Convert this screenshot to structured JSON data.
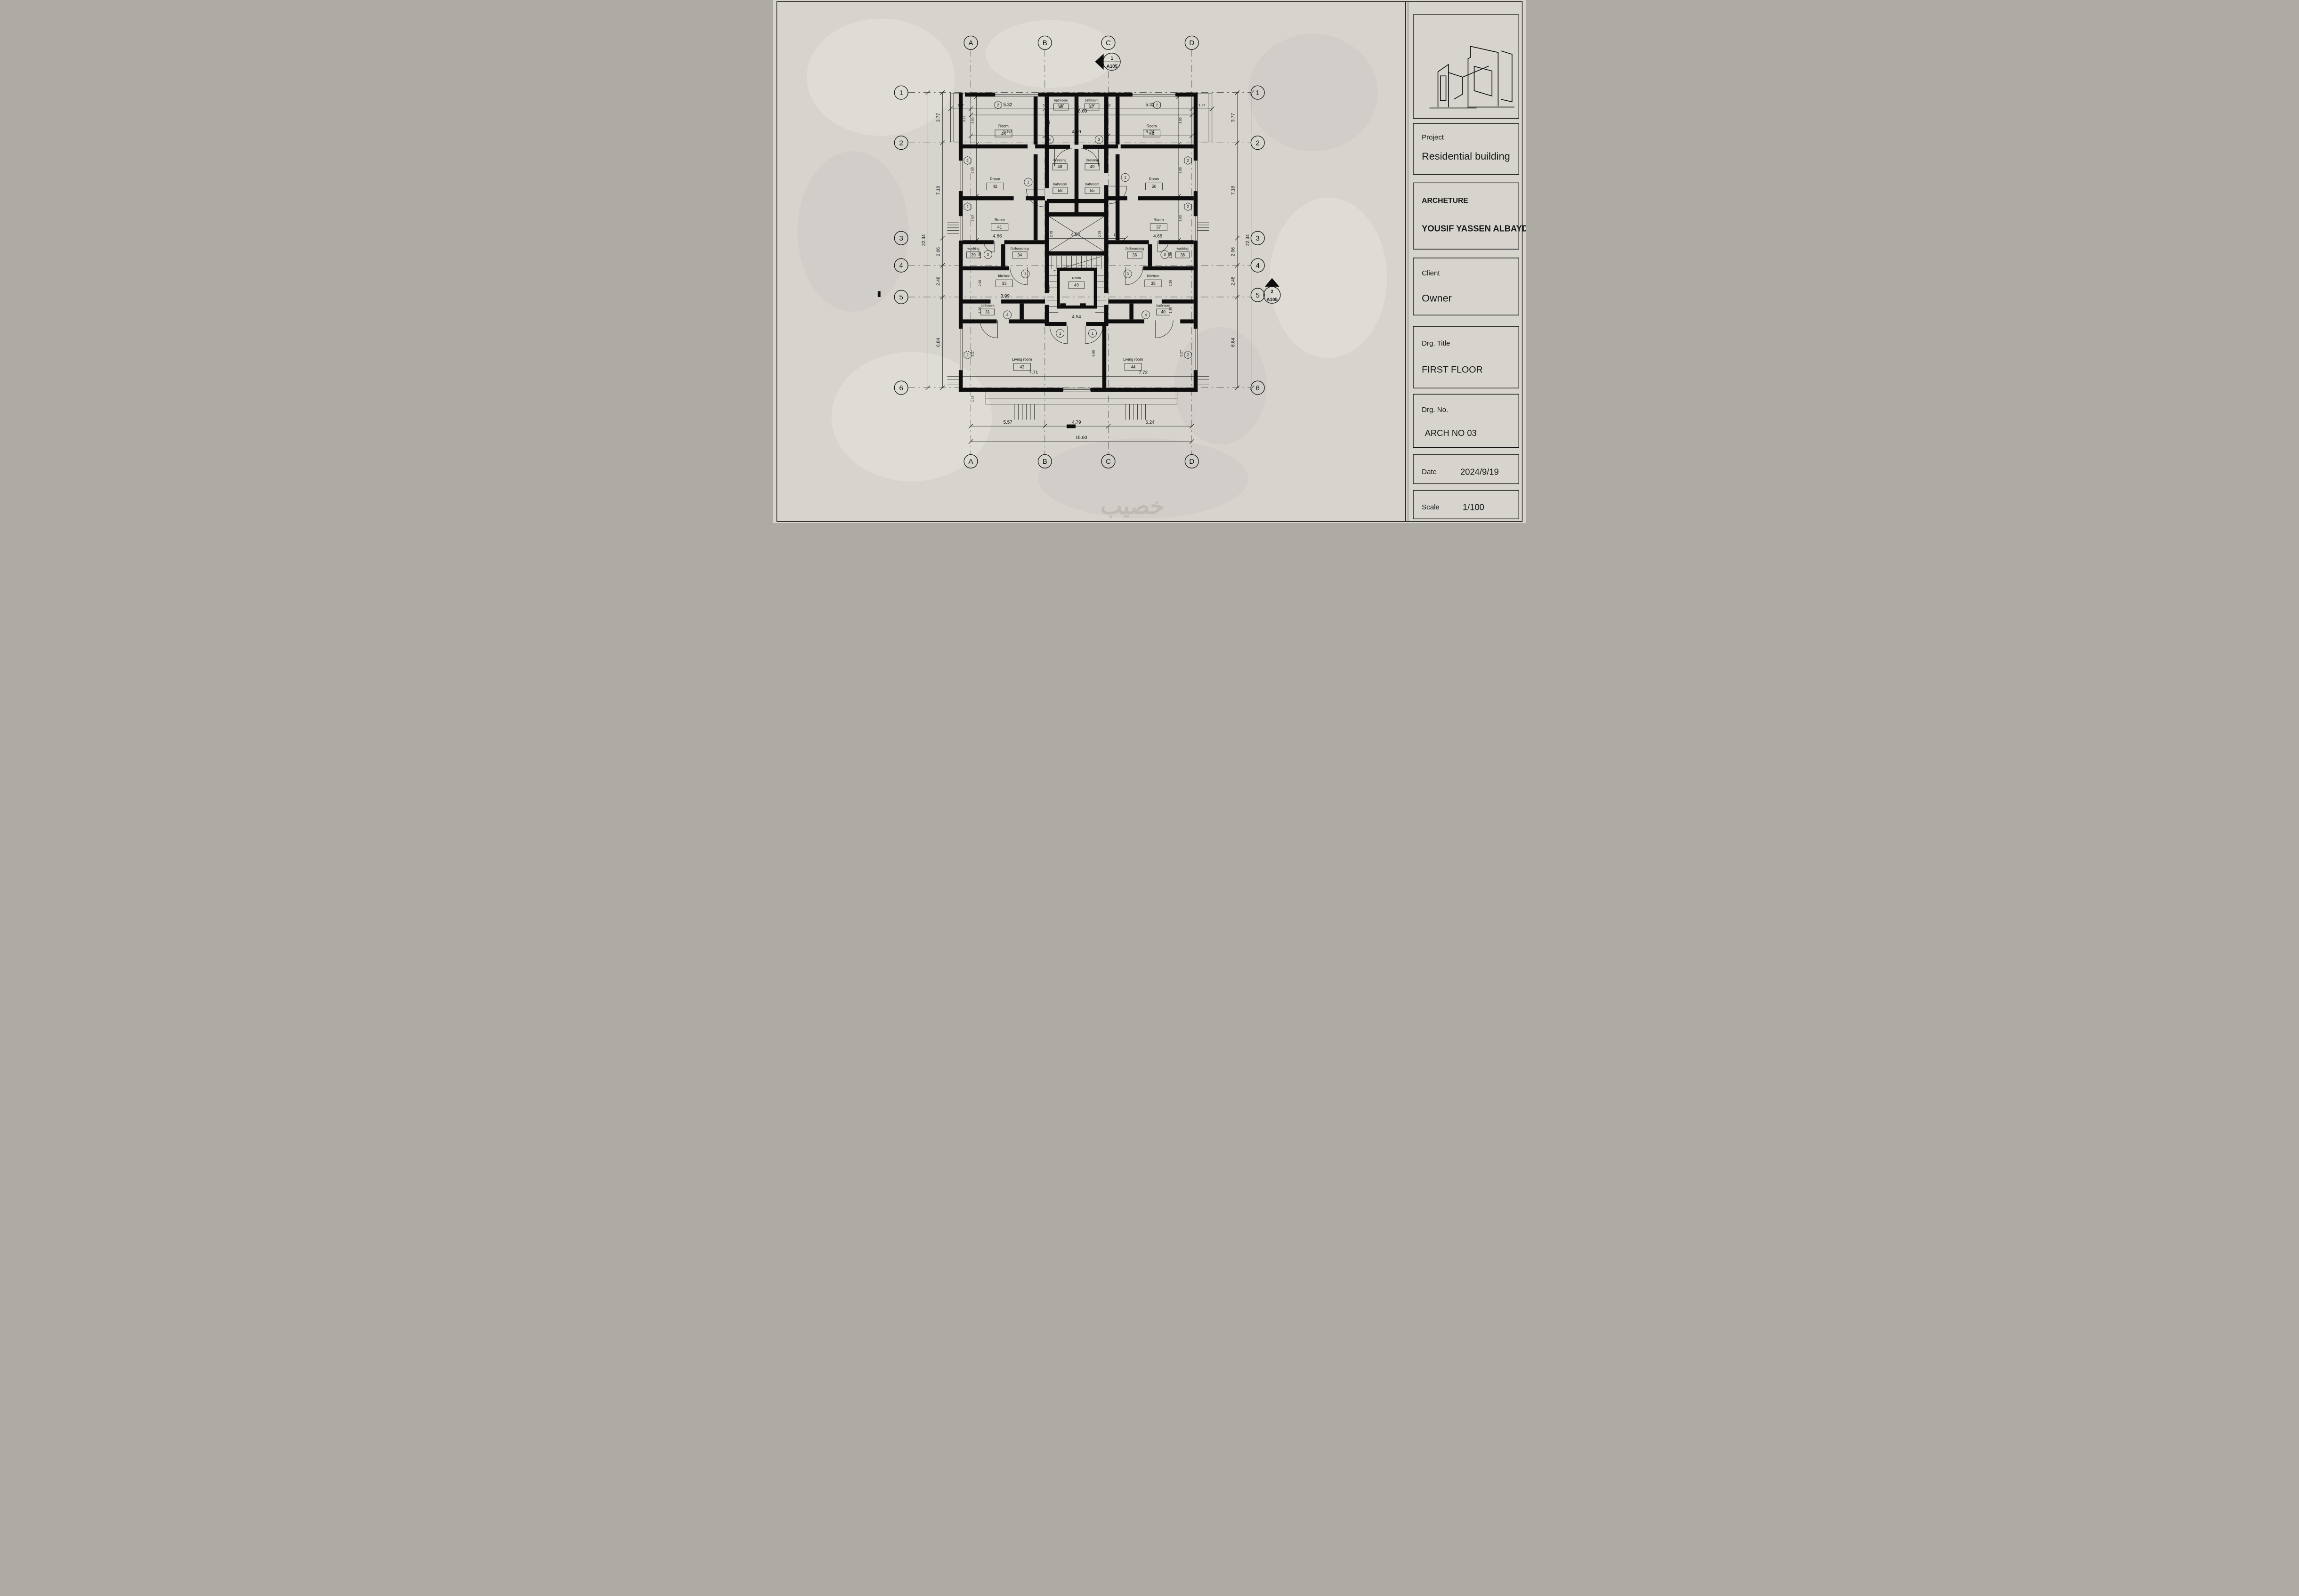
{
  "sheet": {
    "watermark": "خصيب",
    "title_block": {
      "project_label": "Project",
      "project_value": "Residential building",
      "architect_label": "ARCHETURE",
      "architect_value": "YOUSIF YASSEN ALBAYDA",
      "client_label": "Client",
      "client_value": "Owner",
      "drg_title_label": "Drg. Title",
      "drg_title_value": "FIRST FLOOR",
      "drg_no_label": "Drg. No.",
      "drg_no_value": "ARCH NO 03",
      "date_label": "Date",
      "date_value": "2024/9/19",
      "scale_label": "Scale",
      "scale_value": "1/100"
    }
  },
  "plan": {
    "grid": {
      "cols": [
        "A",
        "B",
        "C",
        "D"
      ],
      "rows": [
        "1",
        "2",
        "3",
        "4",
        "5",
        "6"
      ]
    },
    "dims": {
      "top_total": "16.60",
      "top": [
        "5.57",
        "4.79",
        "6.24"
      ],
      "bottom_total": "16.60",
      "bottom": [
        "5.57",
        "4.79",
        "6.24"
      ],
      "left_total": "22.34",
      "left": [
        "3.77",
        "7.18",
        "2.06",
        "2.48",
        "6.84"
      ],
      "right_total": "22.34",
      "right": [
        "3.77",
        "7.18",
        "2.06",
        "2.48",
        "6.84"
      ],
      "inner": {
        "balcony_w": "1.27",
        "balcony_h": "3.72",
        "room_w": "5.32",
        "bath_w": "2.27",
        "wall": "0.63",
        "hall_h": "2.40",
        "room_h1": "3.60",
        "room_h2": "3.60",
        "room_h3": "3.63",
        "room41_w": "4.66",
        "shaft_w": "4.54",
        "shaft_h": "2.78",
        "stair_h": "4.43",
        "stair_w": "4.54",
        "corridor": "1.20",
        "washing_h": "1.56",
        "kitchen_h": "2.50",
        "kitchen_w": "3.99",
        "bath_h": "1.20",
        "living_h": "5.27",
        "living_w_l": "7.71",
        "living_w_r": "7.72",
        "living_c": "8.05",
        "terrace_h": "1.39"
      }
    },
    "rooms": {
      "l_room1": {
        "name": "Room",
        "tag": "45"
      },
      "l_room2": {
        "name": "Room",
        "tag": "42"
      },
      "l_room3": {
        "name": "Room",
        "tag": "41"
      },
      "l_washing": {
        "name": "washing",
        "tag": "39"
      },
      "l_dishwashing": {
        "name": "Dishwashing",
        "tag": "34"
      },
      "l_kitchen": {
        "name": "kitchen",
        "tag": "33"
      },
      "l_bath_low": {
        "name": "bathroom",
        "tag": "31"
      },
      "l_living": {
        "name": "Living room",
        "tag": "43"
      },
      "l_bath_top": {
        "name": "bathroom",
        "tag": "46"
      },
      "l_dressing": {
        "name": "Dressing",
        "tag": "48"
      },
      "l_bath_mid": {
        "name": "bathroom",
        "tag": "58"
      },
      "r_room1": {
        "name": "Room",
        "tag": "54"
      },
      "r_room2": {
        "name": "Room",
        "tag": "50"
      },
      "r_room3": {
        "name": "Room",
        "tag": "37"
      },
      "r_washing": {
        "name": "washing",
        "tag": "38"
      },
      "r_dishwashing": {
        "name": "Dishwashing",
        "tag": "36"
      },
      "r_kitchen": {
        "name": "kitchen",
        "tag": "35"
      },
      "r_bath_low": {
        "name": "bathroom",
        "tag": "40"
      },
      "r_living": {
        "name": "Living room",
        "tag": "44"
      },
      "r_bath_top": {
        "name": "bathroom",
        "tag": "47"
      },
      "r_dressing": {
        "name": "Dressing",
        "tag": "49"
      },
      "r_bath_mid": {
        "name": "bathroom",
        "tag": "55"
      },
      "elevator": {
        "name": "Room",
        "tag": "49"
      }
    },
    "tags": {
      "door1": "1",
      "win2": "2",
      "door3": "3",
      "door4": "4"
    },
    "sections": {
      "s1": {
        "num": "1",
        "sheet": "A105"
      },
      "s2": {
        "num": "2",
        "sheet": "A105"
      }
    }
  }
}
